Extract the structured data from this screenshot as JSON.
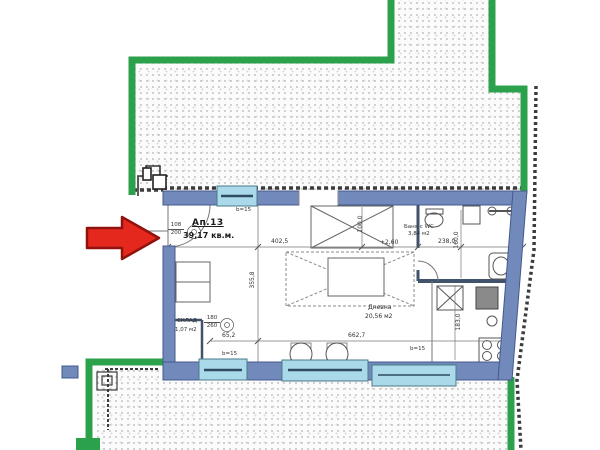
{
  "apartment": {
    "number": "Ап.13",
    "total_area": "39,17 кв.м."
  },
  "rooms": {
    "living": {
      "name": "Дневна",
      "area": "20,56 м2"
    },
    "bath": {
      "name": "Баня с WC",
      "area": "3,84 м2"
    },
    "storage": {
      "name": "СКЛАД",
      "area": "1,07 м2"
    }
  },
  "door_specs": {
    "entry_width": "108",
    "entry_height": "200",
    "storage_width": "180",
    "storage_height": "260"
  },
  "dimensions": {
    "living_width": "402,5",
    "living_depth": "355,8",
    "bottom_total": "662,7",
    "storage_width": "65,2",
    "bed_zone": "100,0",
    "bath_width": "238,0",
    "bath_depth": "160,0",
    "kitchen_depth": "183,0",
    "level": "+2,60",
    "wall_thickness": "b=15"
  },
  "colors": {
    "site_boundary_green": "#2ba14c",
    "apartment_wall_blue": "#7289bb",
    "window_cyan": "#aadae9",
    "arrow_red": "#e5281e"
  }
}
